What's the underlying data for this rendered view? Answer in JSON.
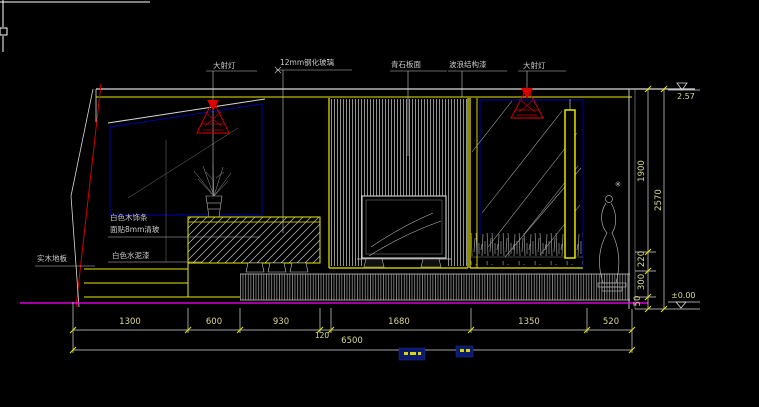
{
  "canvas": {
    "bg": "#000000"
  },
  "colors": {
    "line": "#d9d9d9",
    "yellow": "#ede800",
    "blue": "#0000b4",
    "red": "#e00000",
    "magenta": "#ff00ff",
    "dim_text": "#d9d98f",
    "label_text": "#c9c9c9"
  },
  "annotations": {
    "spotlight_left": "大射灯",
    "spotlight_right": "大射灯",
    "tempered_glass": "12mm钢化玻璃",
    "stone_slab": "青石板面",
    "texture_paint": "波浪结构漆",
    "white_wood_trim": "白色木饰条",
    "glass_overlay": "面贴8mm清玻",
    "white_cement_paint": "白色水泥漆",
    "wood_floor": "实木地板"
  },
  "levels": {
    "ceiling": "2.57",
    "floor": "±0.00"
  },
  "dimensions": {
    "horizontal": [
      "1300",
      "600",
      "930",
      "120",
      "1680",
      "1350",
      "520"
    ],
    "horizontal_total": "6500",
    "vertical": [
      "1900",
      "220",
      "300",
      "50"
    ],
    "vertical_total": "2570"
  }
}
